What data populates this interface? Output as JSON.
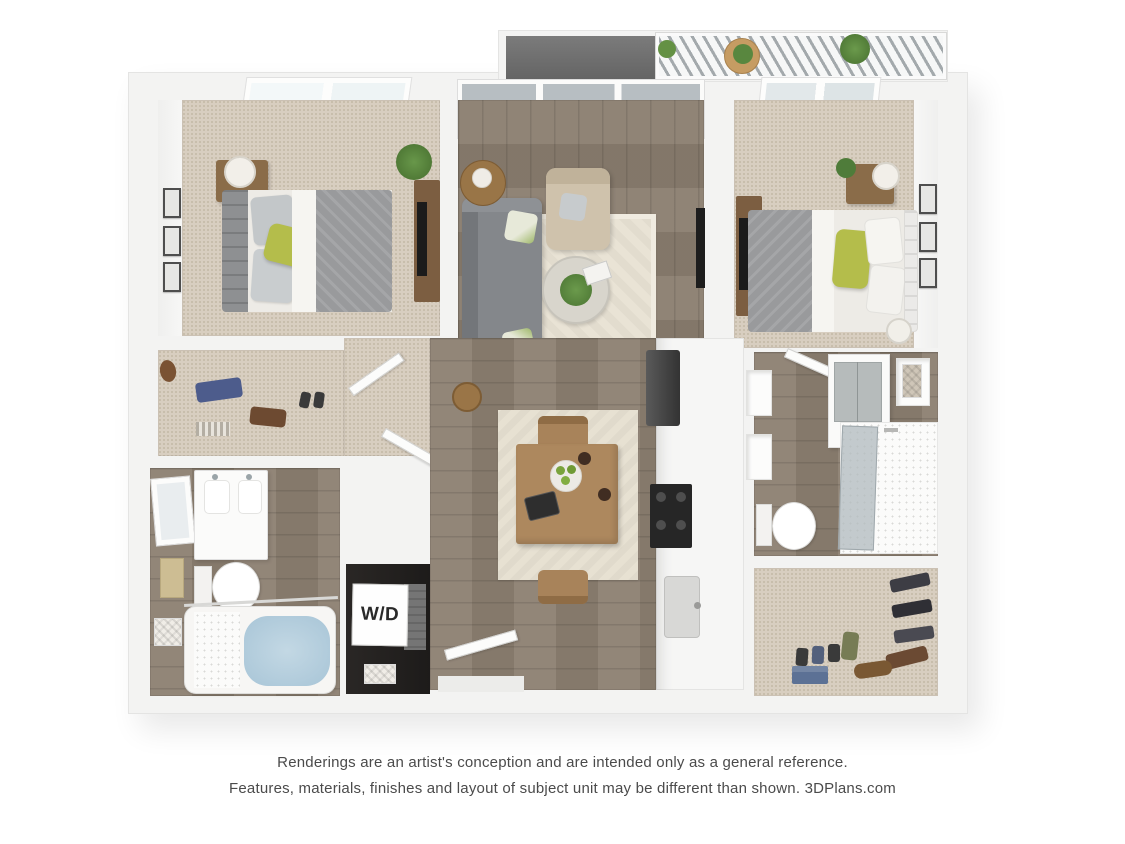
{
  "floorplan": {
    "washer_dryer_label": "W/D",
    "regions": [
      "balcony",
      "bedroom-1",
      "living-room",
      "bedroom-2",
      "walk-in-closet-1",
      "bathroom-1",
      "washer-dryer-closet",
      "hallway",
      "dining-area",
      "kitchen",
      "bathroom-2",
      "walk-in-closet-2",
      "entry"
    ],
    "palette": {
      "wall": "#f3f3f2",
      "carpet": "#d8cec0",
      "wood_floor": "#8c7f71",
      "accent_green_pillow": "#b4bd4b",
      "sofa_gray": "#84878b",
      "bed_duvet_gray": "#999a9c",
      "bath_water_blue": "#a8c5d7",
      "appliance_black": "#262626"
    }
  },
  "disclaimer": {
    "line1": "Renderings are an artist's conception and are intended only as a general reference.",
    "line2": "Features, materials, finishes and layout of subject unit may be different than shown. 3DPlans.com"
  }
}
